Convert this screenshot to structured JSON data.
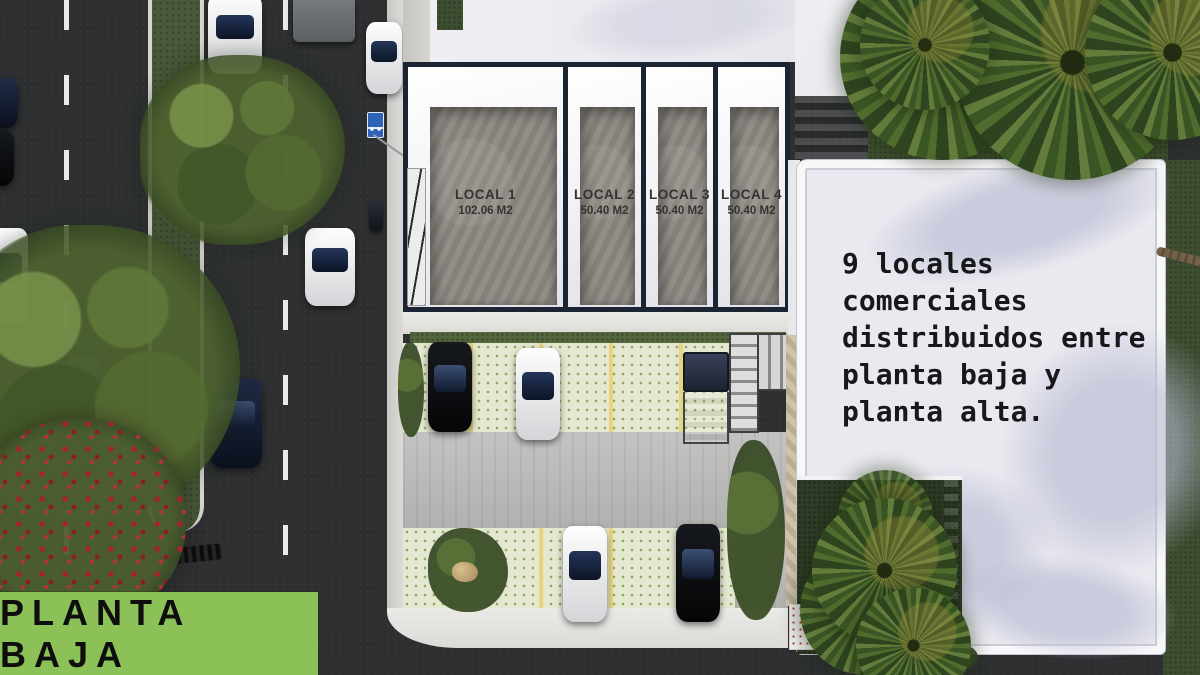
{
  "badge": {
    "label": "PLANTA BAJA"
  },
  "annotation": {
    "text": "9 locales\ncomerciales\ndistribuidos entre\nplanta baja y\nplanta alta."
  },
  "locals": [
    {
      "name": "LOCAL 1",
      "area": "102.06 M2"
    },
    {
      "name": "LOCAL 2",
      "area": "50.40 M2"
    },
    {
      "name": "LOCAL 3",
      "area": "50.40 M2"
    },
    {
      "name": "LOCAL 4",
      "area": "50.40 M2"
    }
  ],
  "colors": {
    "badge_green": "#8cc158",
    "frame_navy": "#1b2433",
    "roof_white": "#e9e9f0",
    "asphalt": "#2d2f31",
    "paver_green": "#e4e8d0",
    "grass_dark": "#3e4e30"
  }
}
